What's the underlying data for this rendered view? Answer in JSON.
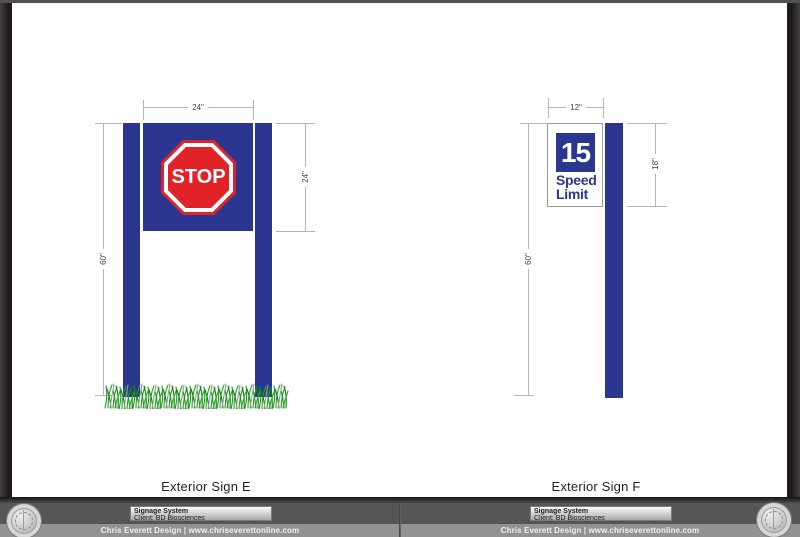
{
  "pages": {
    "left": {
      "sign_label": "Exterior Sign E",
      "sign": {
        "stop_text": "STOP"
      },
      "dims": {
        "width": "24\"",
        "height": "24\"",
        "post": "60\""
      }
    },
    "right": {
      "sign_label": "Exterior Sign F",
      "sign": {
        "value": "15",
        "word1": "Speed",
        "word2": "Limit"
      },
      "dims": {
        "width": "12\"",
        "height": "18\"",
        "post": "60\""
      }
    }
  },
  "title_block": {
    "title": "Signage System",
    "client": "Client: BD Biosciences"
  },
  "credit": "Chris Everett Design | www.chriseverettonline.com",
  "colors": {
    "sign_blue": "#2b3691",
    "stop_red": "#e12227",
    "grass_green": "#1da21d",
    "frame_dark": "#272324",
    "bar_gray": "#565658",
    "strip_gray": "#929294"
  },
  "icons": {
    "seal_stamp": "circular embossed designer seal",
    "grass": "grass tufts at post base"
  }
}
